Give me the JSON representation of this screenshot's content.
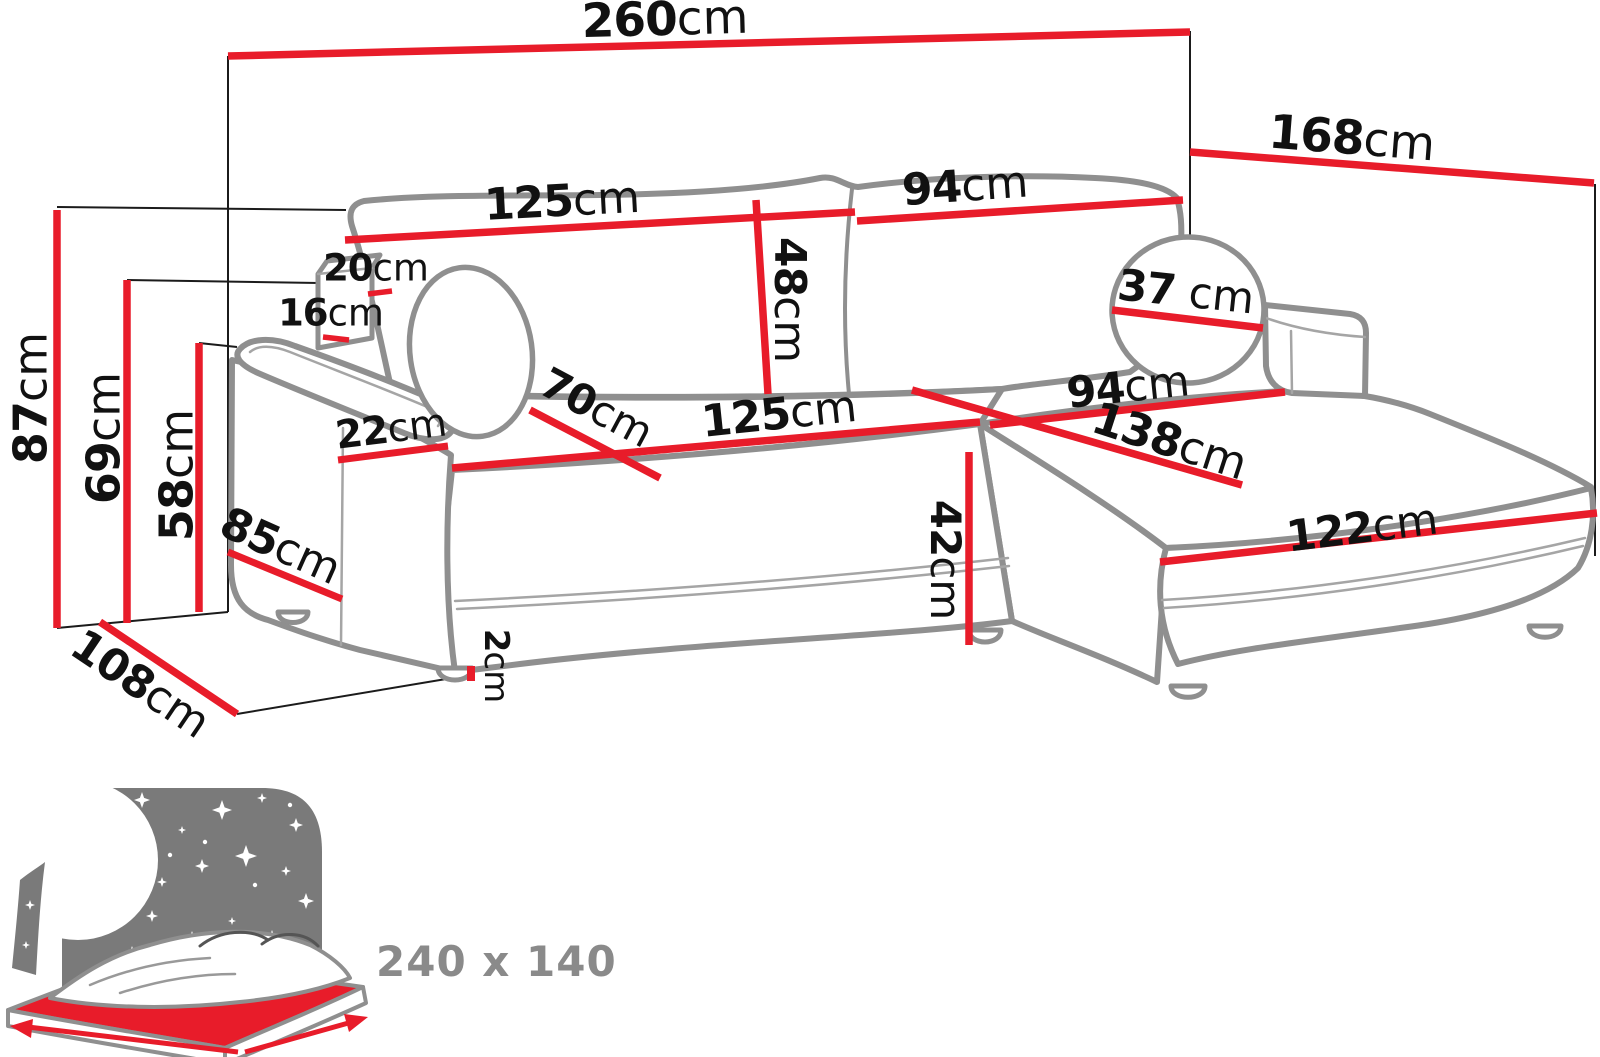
{
  "dims": {
    "total_width": {
      "value": "260",
      "unit": "cm"
    },
    "total_depth": {
      "value": "168",
      "unit": "cm"
    },
    "height_total": {
      "value": "87",
      "unit": "cm"
    },
    "height_back_cushion": {
      "value": "69",
      "unit": "cm"
    },
    "height_seat_back": {
      "value": "58",
      "unit": "cm"
    },
    "back_cushion_left_width": {
      "value": "125",
      "unit": "cm"
    },
    "back_cushion_right_width": {
      "value": "94",
      "unit": "cm"
    },
    "back_cushion_height": {
      "value": "48",
      "unit": "cm"
    },
    "armrest_top_width": {
      "value": "20",
      "unit": "cm"
    },
    "armrest_top_depth": {
      "value": "16",
      "unit": "cm"
    },
    "armrest_front_width": {
      "value": "22",
      "unit": "cm"
    },
    "armrest_side_depth": {
      "value": "85",
      "unit": "cm"
    },
    "seat_cushion_depth": {
      "value": "70",
      "unit": "cm"
    },
    "seat_width": {
      "value": "125",
      "unit": "cm"
    },
    "seat_height": {
      "value": "42",
      "unit": "cm"
    },
    "leg_height": {
      "value": "2",
      "unit": "cm"
    },
    "chaise_width": {
      "value": "94",
      "unit": "cm"
    },
    "chaise_length": {
      "value": "138",
      "unit": "cm"
    },
    "chaise_front_length": {
      "value": "122",
      "unit": "cm"
    },
    "bolster_diameter": {
      "value": "37",
      "unit": " cm"
    },
    "side_depth": {
      "value": "108",
      "unit": "cm"
    }
  },
  "bed": {
    "size_label": "240 x 140"
  },
  "colors": {
    "dimension_line": "#e81c2a",
    "sofa_outline": "#8f8f8f",
    "label_text": "#111111",
    "bed_text": "#8a8a8a",
    "headboard_gray": "#7a7a7a",
    "star_fill": "#ffffff"
  }
}
